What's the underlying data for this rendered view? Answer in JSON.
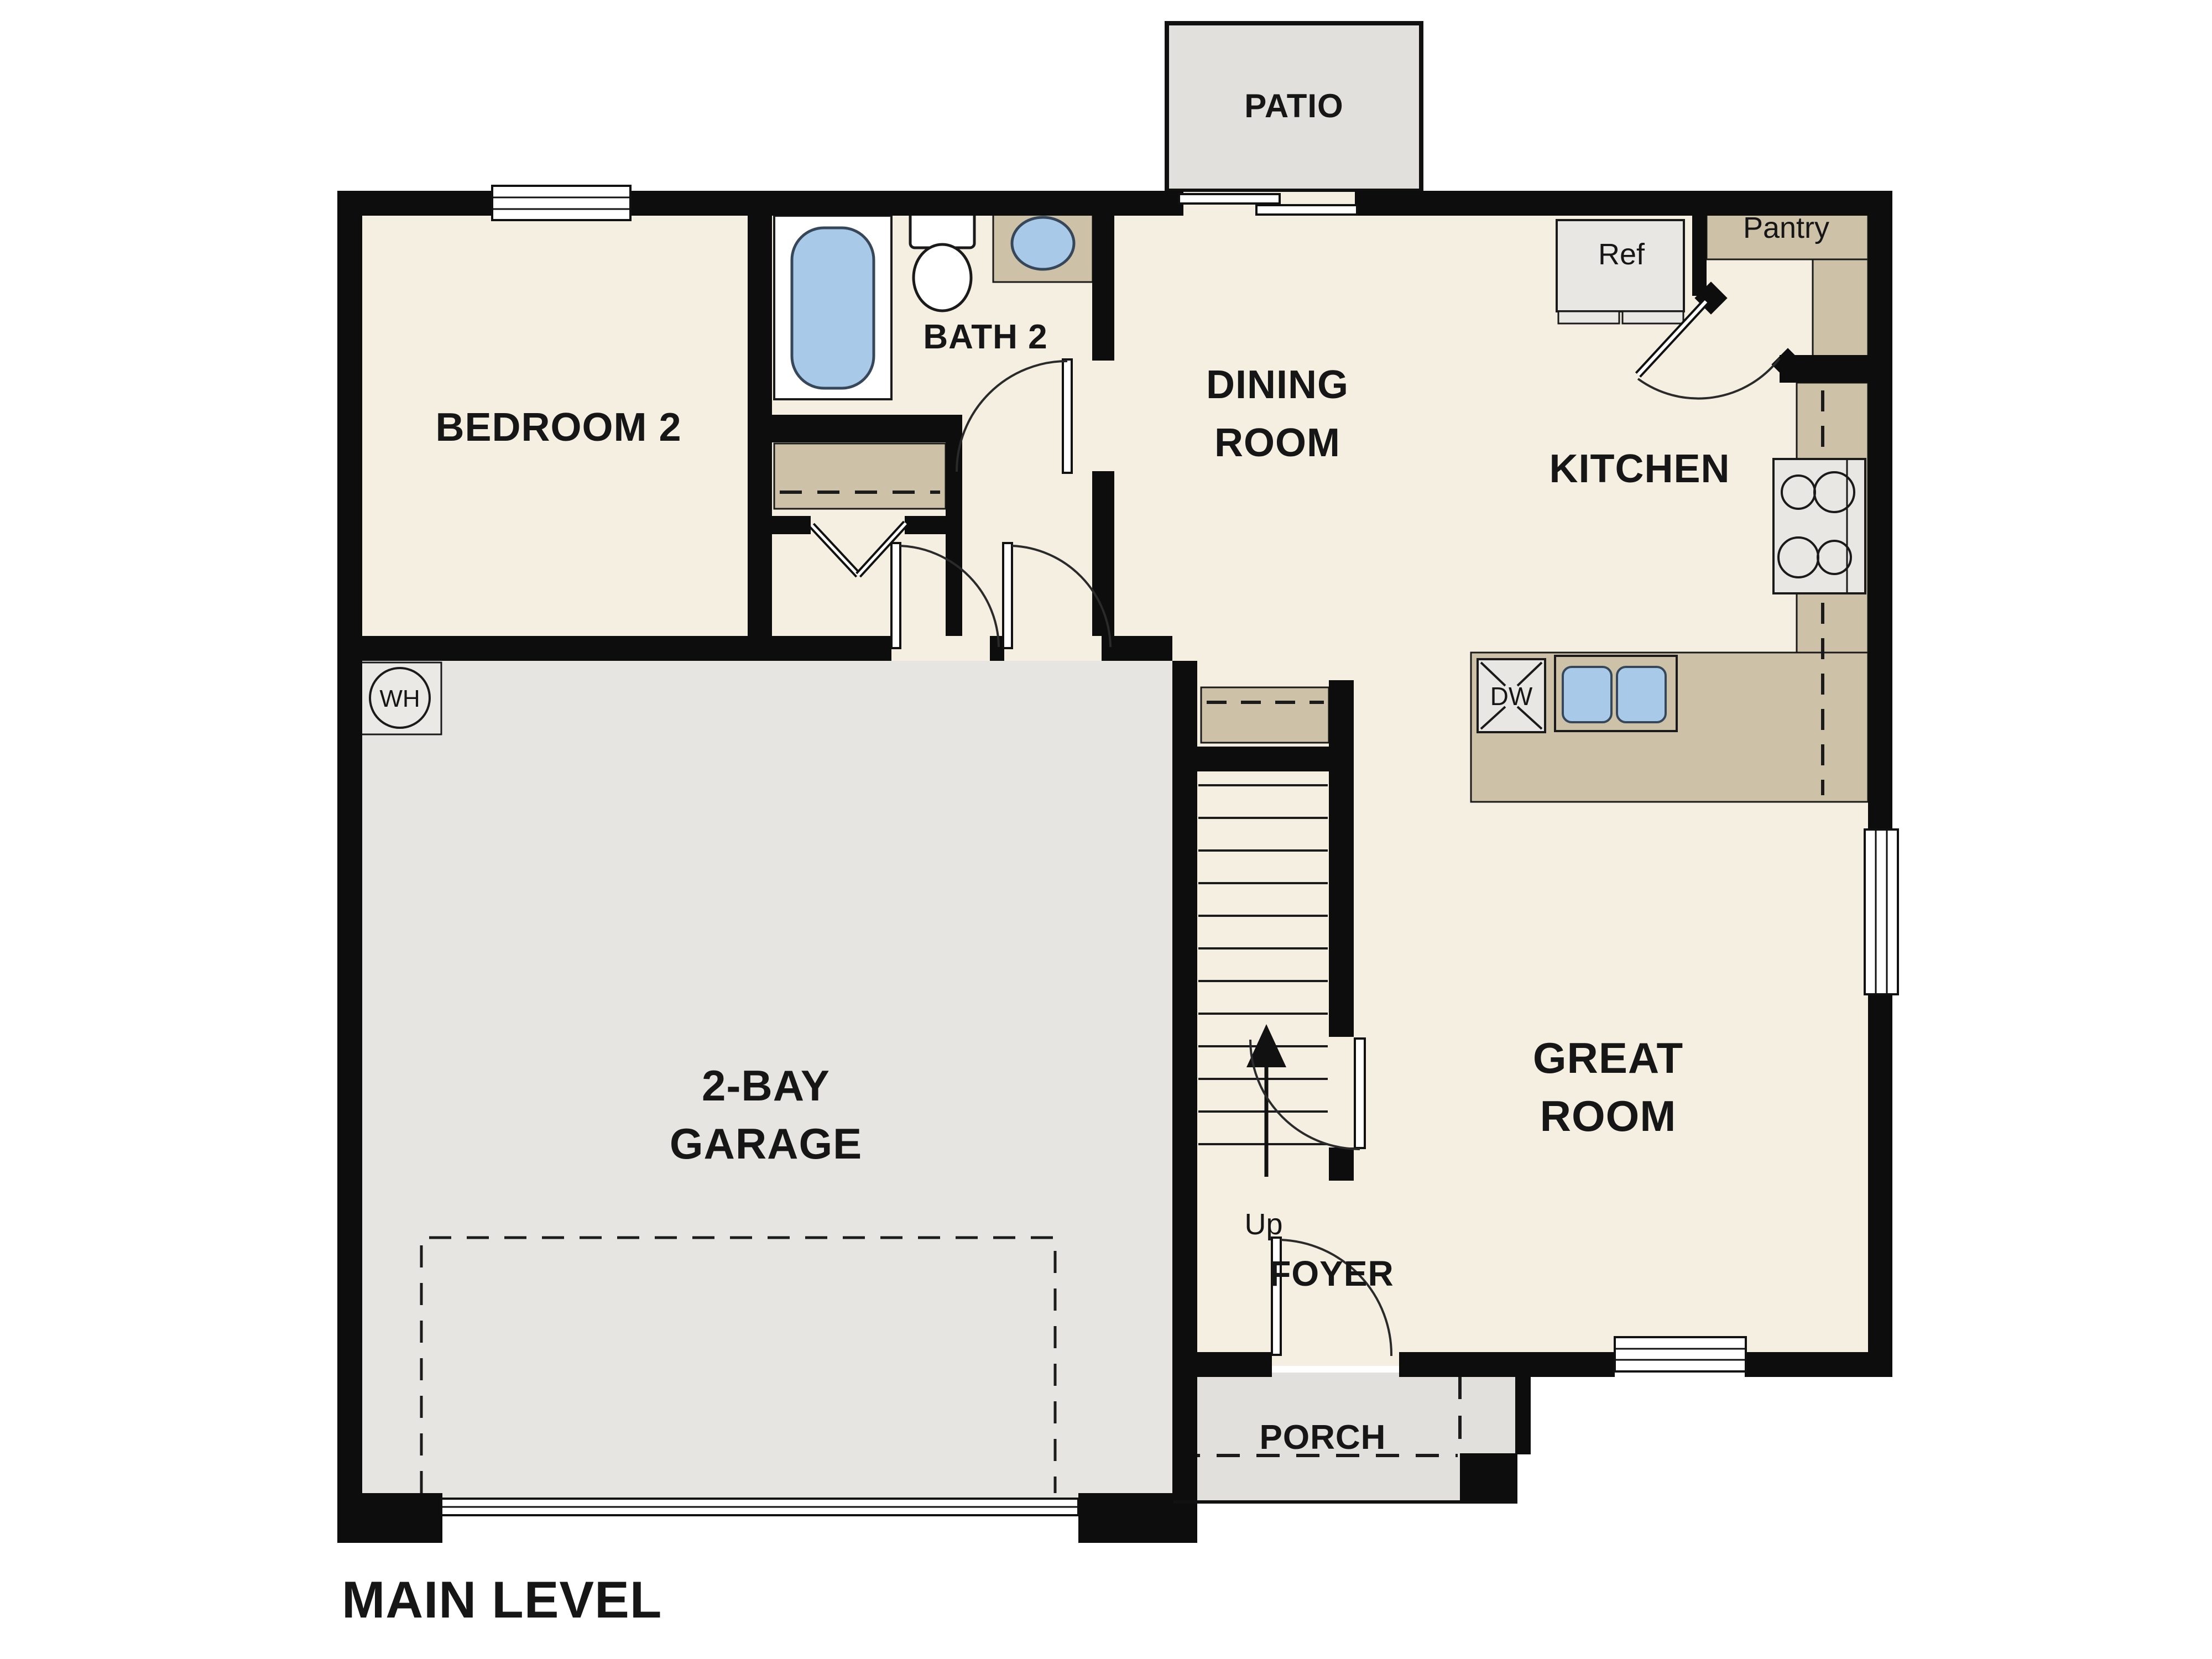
{
  "plan": {
    "title": "MAIN LEVEL",
    "rooms": {
      "patio": {
        "label": "PATIO"
      },
      "bedroom2": {
        "label": "BEDROOM 2"
      },
      "bath2": {
        "label": "BATH 2"
      },
      "dining": {
        "line1": "DINING",
        "line2": "ROOM"
      },
      "kitchen": {
        "label": "KITCHEN"
      },
      "pantry": {
        "label": "Pantry"
      },
      "garage": {
        "line1": "2-BAY",
        "line2": "GARAGE"
      },
      "great": {
        "line1": "GREAT",
        "line2": "ROOM"
      },
      "foyer": {
        "label": "FOYER"
      },
      "porch": {
        "label": "PORCH"
      }
    },
    "fixtures": {
      "refrigerator": "Ref",
      "dishwasher": "DW",
      "water_heater": "WH",
      "stairs_direction": "Up"
    },
    "colors": {
      "wall": "#0d0d0d",
      "floor_cream": "#f5efe2",
      "outdoor_gray": "#e1e0dd",
      "garage_gray": "#e6e5e2",
      "counter_tan": "#cdc1a8",
      "fixture_blue": "#a9c9e9",
      "appliance_gray": "#e8e7e4"
    }
  }
}
